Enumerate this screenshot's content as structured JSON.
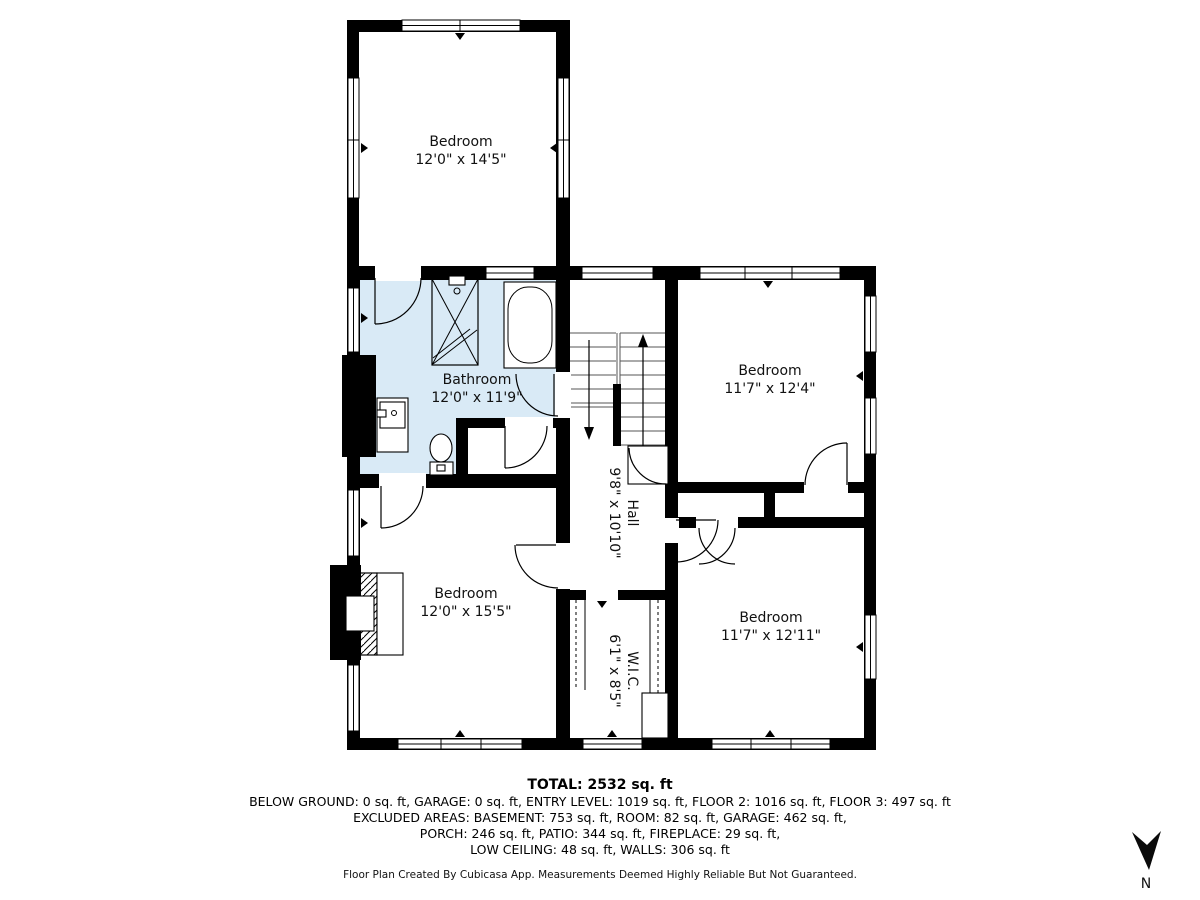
{
  "rooms": {
    "bedroom_top": {
      "name": "Bedroom",
      "dims": "12'0\" x 14'5\""
    },
    "bathroom": {
      "name": "Bathroom",
      "dims": "12'0\" x 11'9\""
    },
    "bedroom_right": {
      "name": "Bedroom",
      "dims": "11'7\" x 12'4\""
    },
    "hall": {
      "name": "Hall",
      "dims": "9'8\" x 10'10\""
    },
    "bedroom_left": {
      "name": "Bedroom",
      "dims": "12'0\" x 15'5\""
    },
    "wic": {
      "name": "W.I.C.",
      "dims": "6'1\" x 8'5\""
    },
    "bedroom_bottom_right": {
      "name": "Bedroom",
      "dims": "11'7\" x 12'11\""
    }
  },
  "summary": {
    "total": "TOTAL: 2532 sq. ft",
    "line1": "BELOW GROUND: 0 sq. ft, GARAGE: 0 sq. ft, ENTRY LEVEL: 1019 sq. ft, FLOOR 2: 1016 sq. ft, FLOOR 3: 497 sq. ft",
    "line2": "EXCLUDED AREAS: BASEMENT: 753 sq. ft, ROOM: 82 sq. ft, GARAGE: 462 sq. ft,",
    "line3": "PORCH: 246 sq. ft, PATIO: 344 sq. ft, FIREPLACE: 29 sq. ft,",
    "line4": "LOW CEILING: 48 sq. ft, WALLS: 306 sq. ft"
  },
  "disclaimer": "Floor Plan Created By Cubicasa App. Measurements Deemed Highly Reliable But Not Guaranteed.",
  "compass": {
    "label": "N"
  },
  "colors": {
    "wall": "#000000",
    "bathroom_fill": "#d9eaf6"
  }
}
